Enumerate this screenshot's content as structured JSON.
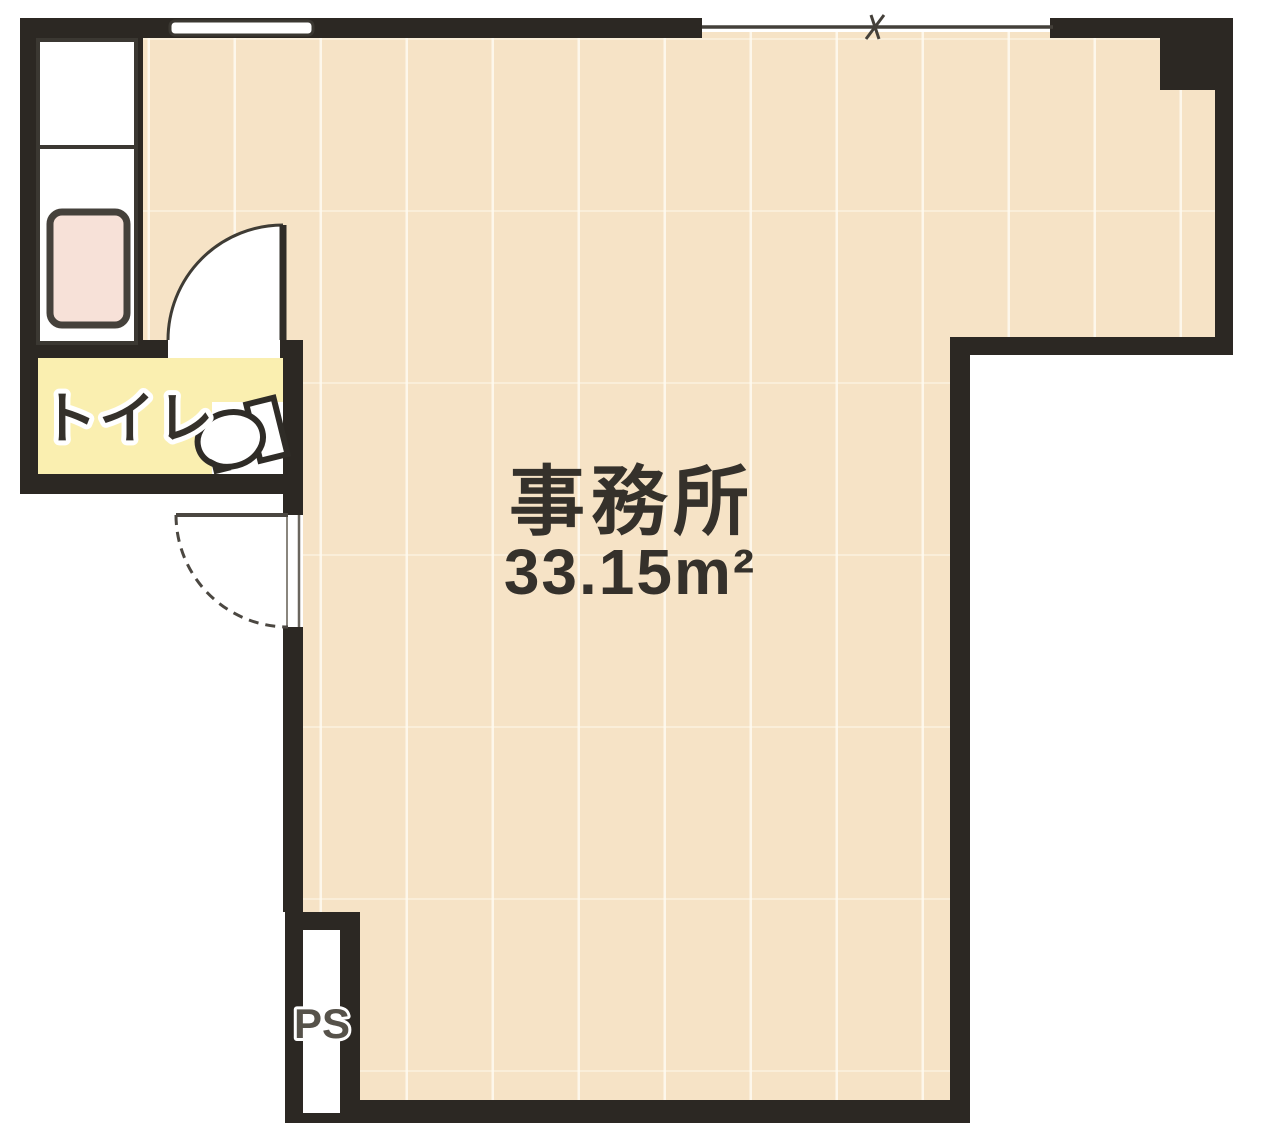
{
  "plan": {
    "type": "floor-plan",
    "labels": {
      "room_name": "事務所",
      "room_area": "33.15m²",
      "toilet": "トイレ",
      "pipe_space": "PS"
    },
    "colors": {
      "wall": "#2c2823",
      "floor": "#f6e3c6",
      "toilet_floor": "#faefb0",
      "sink": "#f7e1d8",
      "ink": "#35312b",
      "door_line": "#4b4741",
      "fixture_outline": "#3b3832"
    }
  }
}
